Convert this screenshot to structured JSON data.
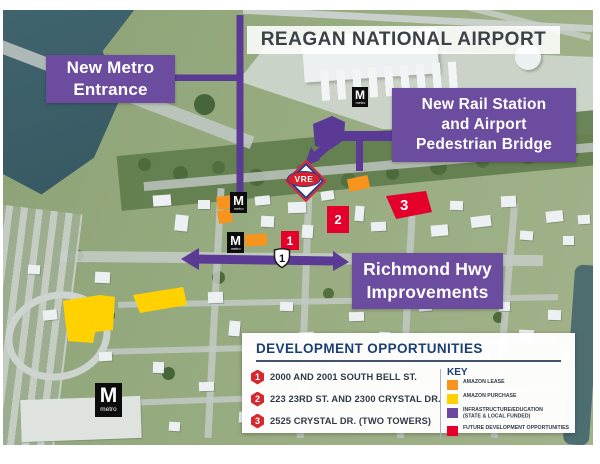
{
  "title_banner": {
    "text": "REAGAN NATIONAL AIRPORT"
  },
  "callouts": {
    "metro_entrance": {
      "lines": [
        "New Metro",
        "Entrance"
      ]
    },
    "rail_station": {
      "lines": [
        "New Rail Station",
        "and Airport",
        "Pedestrian Bridge"
      ]
    },
    "richmond": {
      "lines": [
        "Richmond Hwy",
        "Improvements"
      ]
    }
  },
  "map": {
    "metro_logo": {
      "m": "M",
      "label": "metro"
    },
    "vre_label": "VRE",
    "route_shield": "1",
    "sites": [
      {
        "num": "1"
      },
      {
        "num": "2"
      },
      {
        "num": "3"
      }
    ]
  },
  "legend": {
    "title": "DEVELOPMENT OPPORTUNITIES",
    "items": [
      {
        "num": "1",
        "label": "2000 AND 2001 SOUTH BELL ST."
      },
      {
        "num": "2",
        "label": "223 23RD ST. AND 2300 CRYSTAL DR."
      },
      {
        "num": "3",
        "label": "2525 CRYSTAL DR. (TWO TOWERS)"
      }
    ],
    "key": {
      "title": "KEY",
      "entries": [
        {
          "label": "AMAZON LEASE",
          "color": "#F7941D"
        },
        {
          "label": "AMAZON PURCHASE",
          "color": "#FFD100"
        },
        {
          "label": "INFRASTRUCTURE/EDUCATION",
          "label2": "(STATE & LOCAL FUNDED)",
          "color": "#6B4A9D"
        },
        {
          "label": "FUTURE DEVELOPMENT OPPORTUNITIES",
          "color": "#E4002B"
        }
      ]
    }
  },
  "colors": {
    "callout_purple": "#6C4C9F",
    "infrastructure_purple": "#5B3A96",
    "amazon_lease_orange": "#F7941D",
    "amazon_purchase_yellow": "#FFD100",
    "future_dev_red": "#E4002B",
    "legend_navy": "#1C3F72",
    "vre_red": "#D6212E",
    "water_teal": "#3E616B"
  }
}
